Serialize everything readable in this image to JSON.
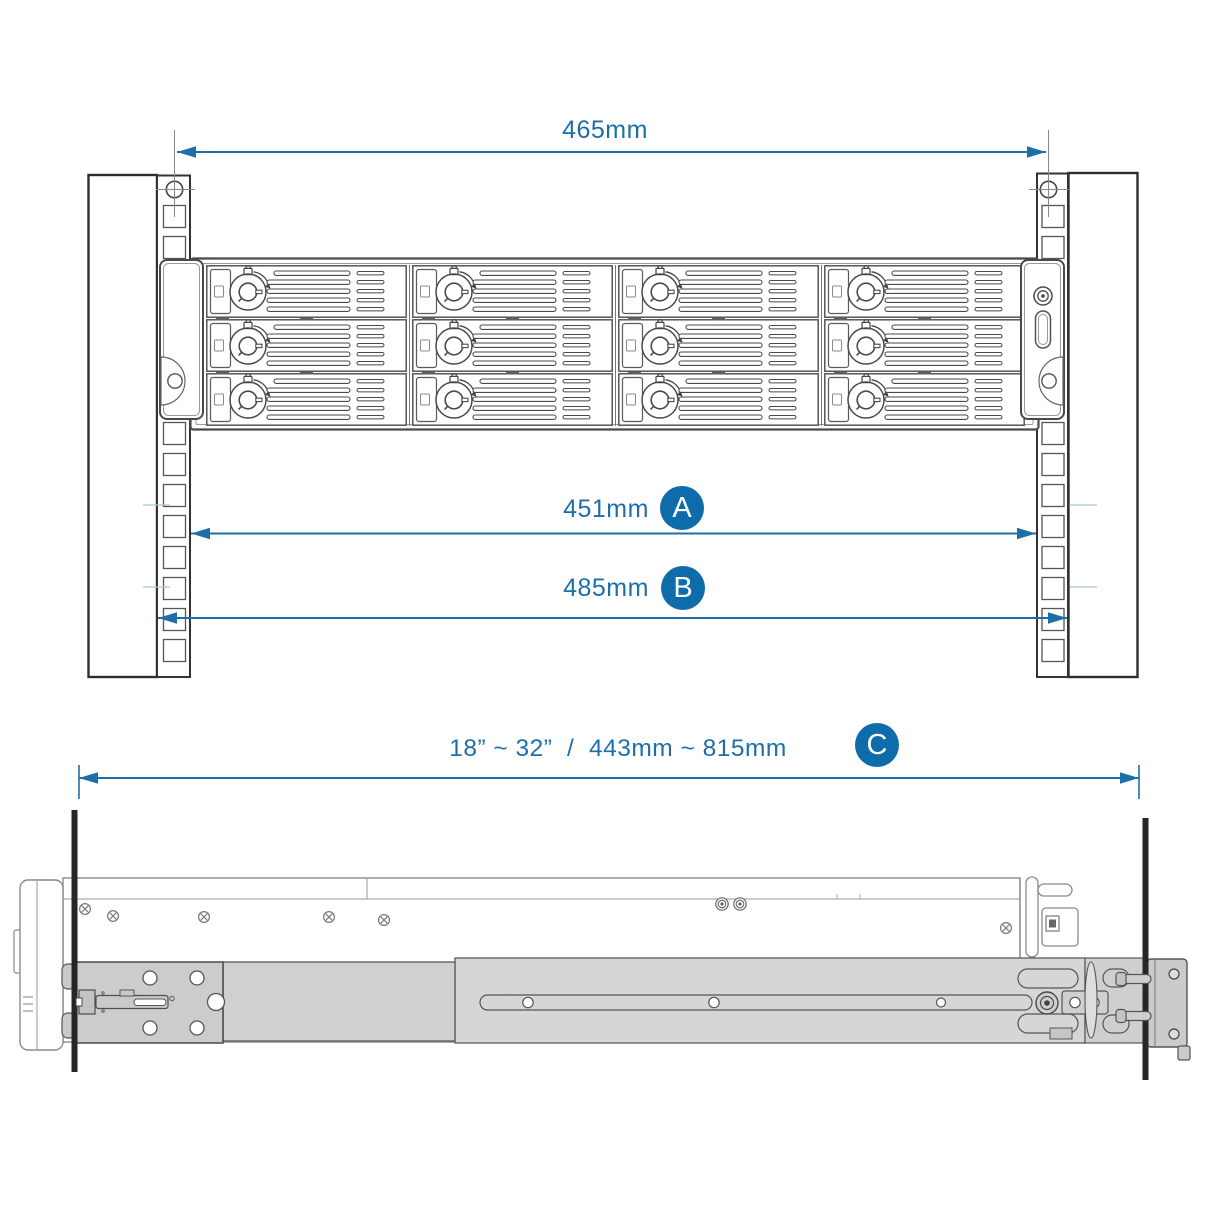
{
  "diagram": {
    "description": "Rack rail kit mounting dimension diagram (front rack view and side rail view)",
    "front_view": {
      "dimension_top": {
        "value": "465mm"
      },
      "dimension_a": {
        "value": "451mm",
        "badge": "A"
      },
      "dimension_b": {
        "value": "485mm",
        "badge": "B"
      },
      "drive_bays": {
        "rows": 3,
        "columns": 4,
        "total": 12
      }
    },
    "side_view": {
      "dimension_c": {
        "value": "18” ~ 32”  /  443mm ~ 815mm",
        "badge": "C"
      }
    },
    "colors": {
      "dimension_blue": "#1e6fa9",
      "badge_blue": "#0e6cab",
      "rail_gray": "#d4d4d4",
      "post_black": "#262626",
      "line_art": "#4a4a4a"
    }
  }
}
